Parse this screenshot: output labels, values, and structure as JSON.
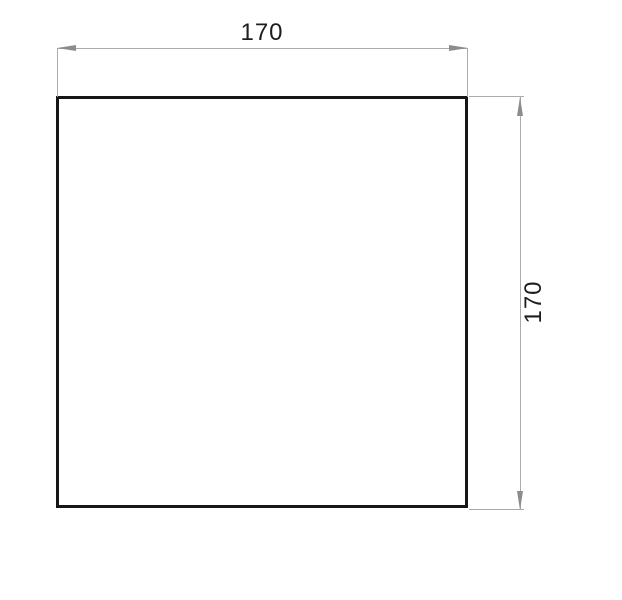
{
  "drawing": {
    "shape": "square",
    "dimensions": {
      "width_label": "170",
      "height_label": "170"
    },
    "colors": {
      "outline": "#161616",
      "dimension_line": "#ababab",
      "arrowhead": "#8c8c8c",
      "label_text": "#1d1d1d",
      "background": "#ffffff"
    }
  }
}
